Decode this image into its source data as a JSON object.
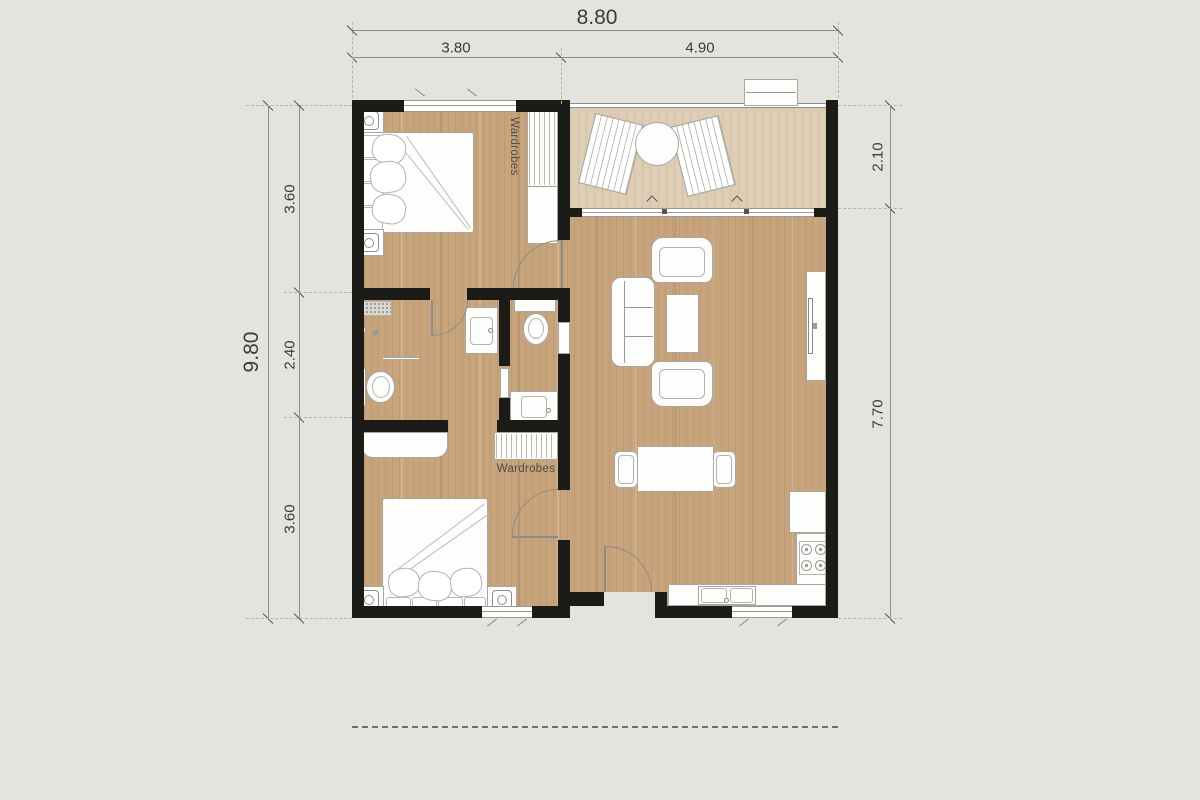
{
  "dimensions": {
    "top_overall": "8.80",
    "top_segments": [
      "3.80",
      "4.90"
    ],
    "left_overall": "9.80",
    "left_segments": [
      "3.60",
      "2.40",
      "3.60"
    ],
    "right_segments": [
      "2.10",
      "7.70"
    ]
  },
  "labels": {
    "wardrobes_bedroom1": "Wardrobes",
    "wardrobes_bedroom2": "Wardrobes"
  },
  "symbols": [
    "double-bed",
    "nightstand-lamp",
    "wardrobe",
    "desk",
    "sofa",
    "armchair",
    "coffee-table",
    "tv-console",
    "dining-table",
    "dining-chair",
    "lounge-chair",
    "round-table",
    "toilet",
    "wash-basin",
    "shower-mat",
    "towel-rail",
    "stove-burners",
    "kitchen-sink",
    "fridge-counter",
    "door-swing",
    "window",
    "sliding-door",
    "balcony-railing",
    "condenser-box"
  ],
  "colors": {
    "background": "#e4e4de",
    "wall": "#1b1b17",
    "wood_floor": "#c7a47c",
    "balcony_floor": "#ddcdb5",
    "fixture_outline": "#a8a8a2",
    "dimension_text": "#3b3b38",
    "overhang_dashed": "#6e6e69"
  }
}
